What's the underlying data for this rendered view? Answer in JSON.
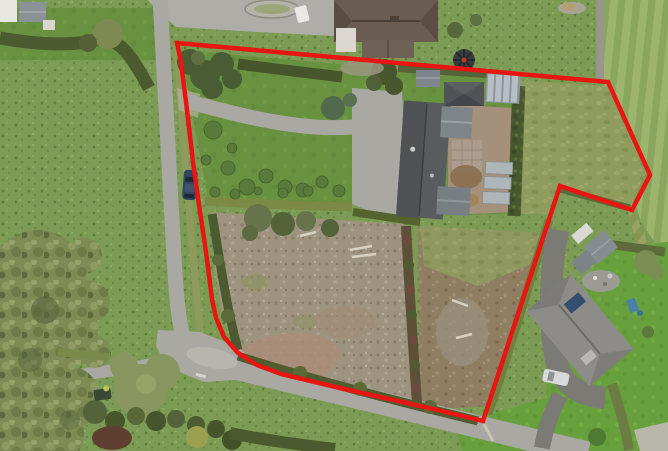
{
  "scene": {
    "type": "aerial-drone-photo",
    "subject": "rural residential property with garden, farmyard outbuildings and bare paddock outlined in red for sale",
    "setting": "country lane T-junction with pasture field left, mowed field right, neighbouring houses top and bottom-right"
  },
  "boundary": {
    "color": "#e81512",
    "stroke_width": 4.5,
    "points": "177,43 608,82 650,175 632,210 560,186 483,421 429,408 340,388 281,374 257,365 238,353 224,337 216,318 212,299 206,252 199,205 193,162 187,110 181,62"
  },
  "palette": {
    "pasture": "#7c9c55",
    "garden_lawn": "#689140",
    "bright_lawn": "#67a03c",
    "road": "#a9a8a2",
    "paddock_left_dirt": "#9d937f",
    "paddock_right_dirt": "#8f7e62",
    "hedge_dark": "#49572e",
    "tree_canopy": "#7e8b55",
    "barn_roof": "#595c5e",
    "main_house_roof": "#6a5c50",
    "neighbor_roof": "#8d8c88",
    "courtyard": "#a5907b",
    "greenhouse": "#b7bfc4",
    "stone_wall": "#98958d",
    "field_stripe_light": "#9cb46c",
    "field_stripe_dark": "#8aa55d"
  },
  "vehicles": {
    "car_on_road": {
      "label": "dark blue car parked on lane",
      "color": "#33455c"
    },
    "car_neighbor": {
      "label": "silver car on neighbour driveway",
      "color": "#d7d9da"
    },
    "car_yard": {
      "label": "white car in top yard",
      "color": "#e8e8e4"
    },
    "vehicle_bottom": {
      "label": "small dark vehicle near junction",
      "color": "#3c4836"
    }
  }
}
